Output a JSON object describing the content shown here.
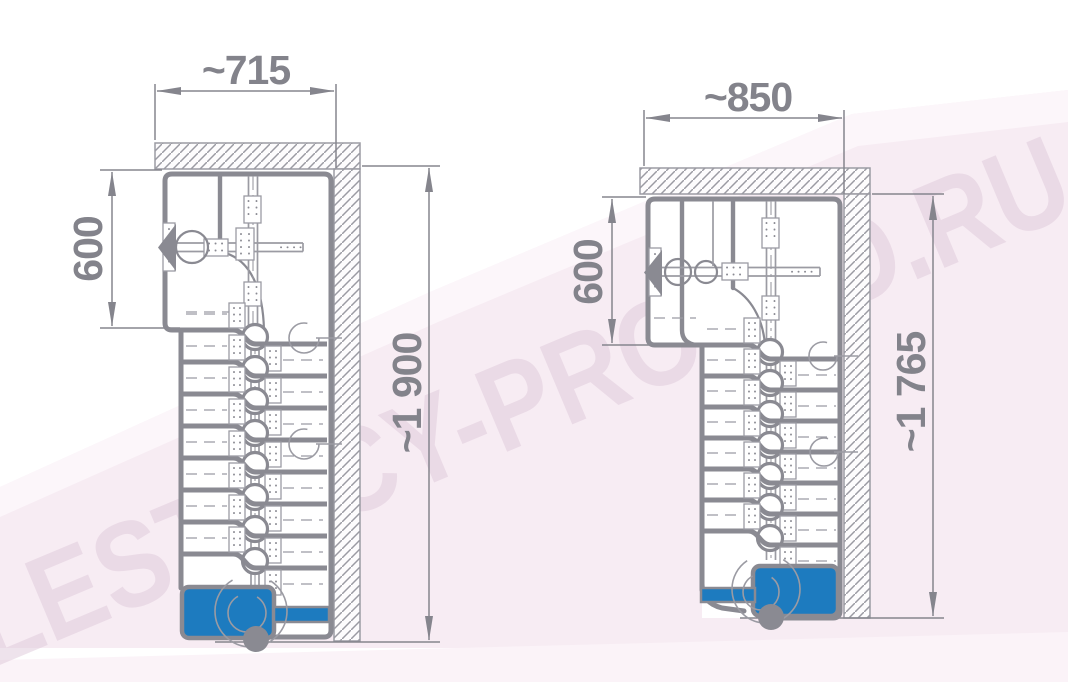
{
  "watermark": {
    "text": "LESTNICY-PROSTO.RU"
  },
  "colors": {
    "accent_blue": "#1d7bbf",
    "line_gray": "#8a8a92",
    "thin_gray": "#9b9ba3",
    "dimension_gray": "#83838b",
    "background_pink": "#f7ecf3",
    "watermark_pink": "#dfc9da"
  },
  "drawings": {
    "left": {
      "name": "staircase-plan-left",
      "width_label": "~715",
      "depth_label": "600",
      "height_label": "~1 900"
    },
    "right": {
      "name": "staircase-plan-right",
      "width_label": "~850",
      "depth_label": "600",
      "height_label": "~1 765"
    }
  }
}
